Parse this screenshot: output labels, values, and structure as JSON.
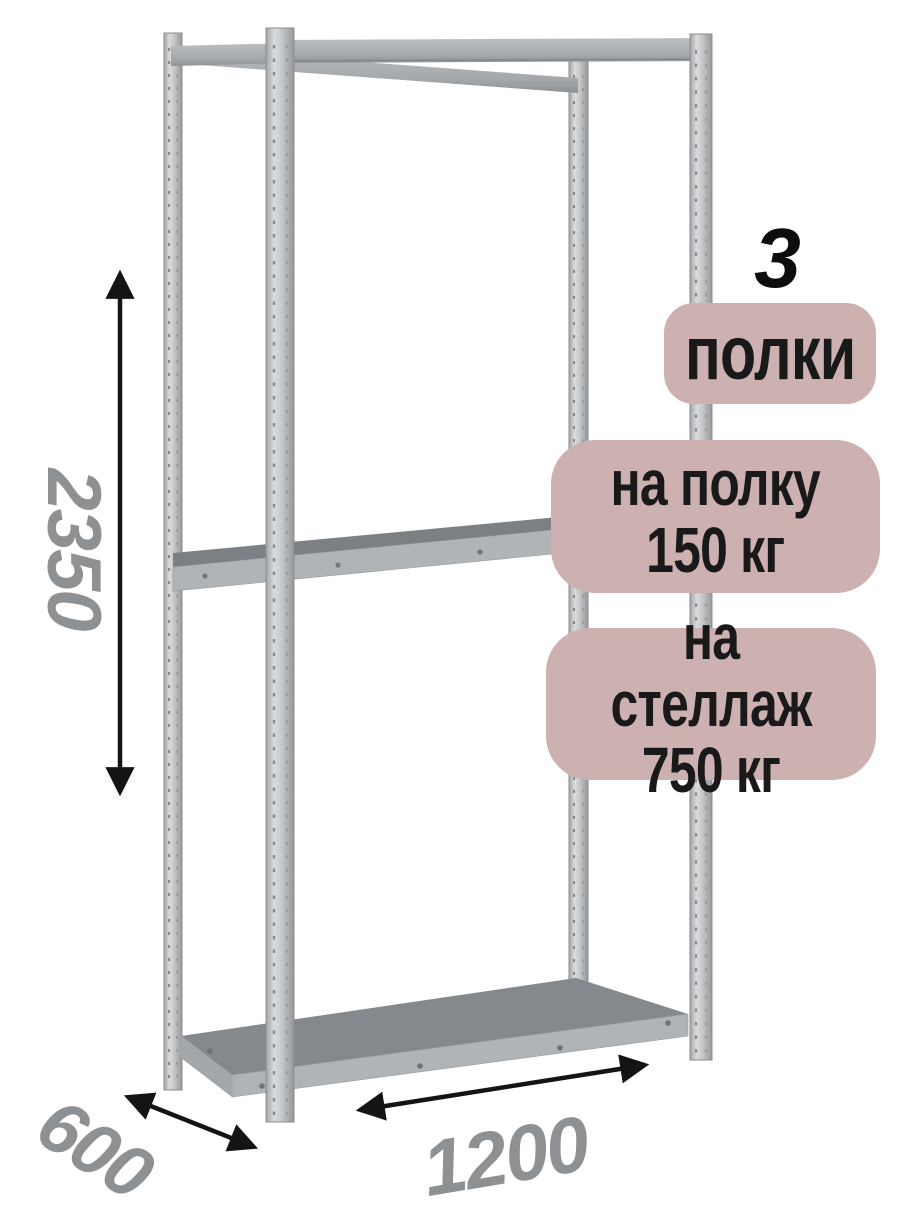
{
  "product_card": {
    "shelf_count": {
      "value": "3",
      "label": "полки"
    },
    "load_per_shelf": {
      "line1": "на полку",
      "line2": "150 кг"
    },
    "load_per_rack": {
      "line1": "на стеллаж",
      "line2": "750 кг"
    }
  },
  "dimensions": {
    "height": "2350",
    "depth": "600",
    "width": "1200"
  },
  "colors": {
    "badge_background": "#cdb1b1",
    "badge_text": "#191919",
    "dimension_text": "#8e9193",
    "arrow": "#141414",
    "metal_light": "#d9dbdd",
    "metal_mid": "#a8acaf",
    "metal_dark": "#95989b",
    "shelf_surface_middle": "#7c8084",
    "shelf_surface_bottom": "#85898d",
    "shelf_edge": "#b1b4b7"
  }
}
